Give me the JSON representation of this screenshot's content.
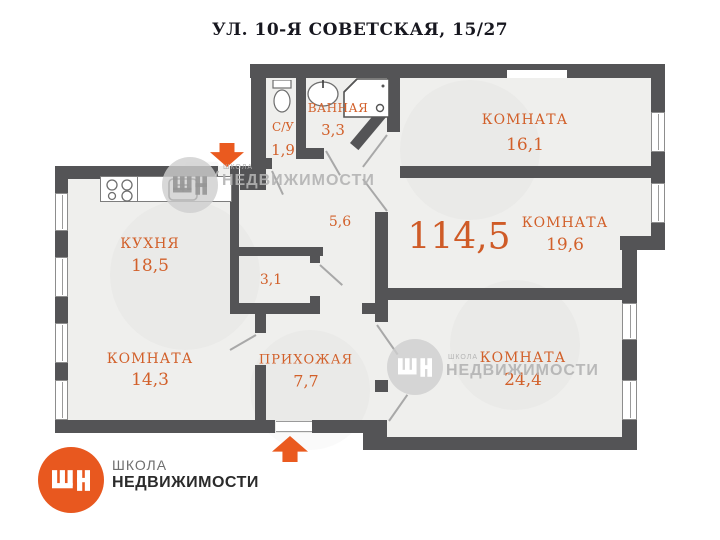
{
  "title": "УЛ. 10-Я СОВЕТСКАЯ, 15/27",
  "total_area": "114,5",
  "rooms": {
    "room1": {
      "label": "КОМНАТА",
      "area": "16,1"
    },
    "room2": {
      "label": "КОМНАТА",
      "area": "19,6"
    },
    "room3": {
      "label": "КОМНАТА",
      "area": "24,4"
    },
    "room4": {
      "label": "КОМНАТА",
      "area": "14,3"
    },
    "kitchen": {
      "label": "КУХНЯ",
      "area": "18,5"
    },
    "hallway": {
      "label": "ПРИХОЖАЯ",
      "area": "7,7"
    },
    "bathroom": {
      "label": "ВАННАЯ",
      "area": "3,3"
    },
    "wc": {
      "label": "С/У",
      "area": "1,9"
    },
    "corridor": {
      "area": "5,6"
    },
    "closet": {
      "area": "3,1"
    }
  },
  "watermarks": {
    "avito": "Avito",
    "school_small": "ШКОЛА",
    "school_name": "НЕДВИЖИМОСТИ"
  },
  "logo": {
    "line1": "ШКОЛА",
    "line2": "НЕДВИЖИМОСТИ"
  },
  "icons": [
    "stove-icon",
    "kitchen-sink-icon",
    "toilet-icon",
    "bath-sink-icon",
    "shower-icon",
    "entrance-arrow-up-icon",
    "entrance-arrow-down-icon",
    "shn-logo-icon"
  ],
  "colors": {
    "accent": "#d2602a",
    "wall": "#545456",
    "floor": "#efefed",
    "logo_orange": "#e8581f"
  }
}
